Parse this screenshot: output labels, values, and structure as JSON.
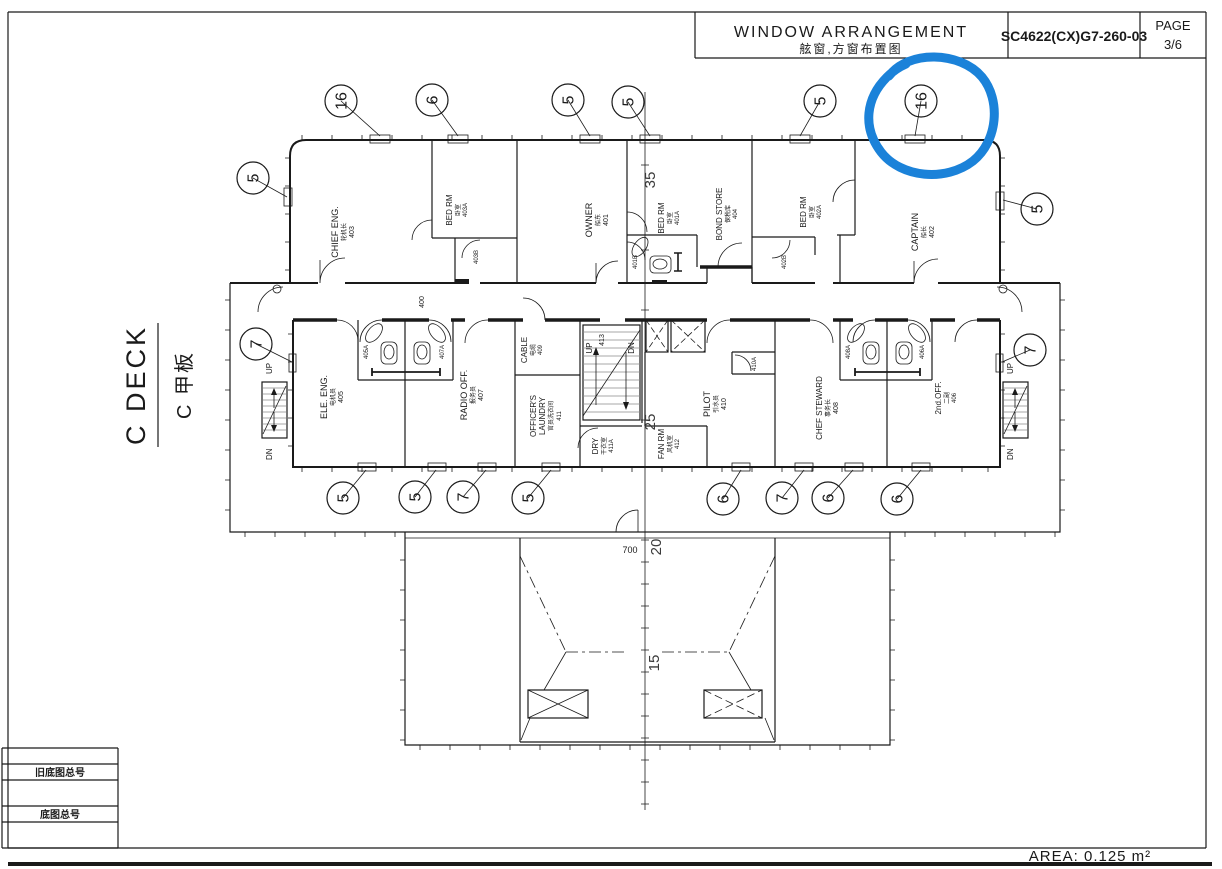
{
  "title_block": {
    "title_en": "WINDOW  ARRANGEMENT",
    "title_zh": "舷窗,方窗布置图",
    "drawing_no": "SC4622(CX)G7-260-03",
    "page_label": "PAGE",
    "page_no": "3/6"
  },
  "deck_label": {
    "en": "C DECK",
    "zh": "C 甲板"
  },
  "footer": {
    "area": "AREA: 0.125 m²"
  },
  "stamp_table": {
    "row1": "旧底图总号",
    "row2": "底图总号"
  },
  "corridor": {
    "no": "400"
  },
  "rooms": {
    "chief_eng": {
      "en": "CHIEF ENG.",
      "zh": "轮机长",
      "no": "403"
    },
    "bed_rm_403a": {
      "en": "BED RM",
      "zh": "卧室",
      "no": "403A"
    },
    "wc_403b": {
      "no": "403B"
    },
    "owner": {
      "en": "OWNER",
      "zh": "船东",
      "no": "401"
    },
    "bed_rm_401a": {
      "en": "BED RM",
      "zh": "卧室",
      "no": "401A"
    },
    "wc_401b": {
      "no": "401B"
    },
    "bond_store": {
      "en": "BOND STORE",
      "zh": "保税库",
      "no": "404"
    },
    "bed_rm_402a": {
      "en": "BED RM",
      "zh": "卧室",
      "no": "402A"
    },
    "wc_402b": {
      "no": "402B"
    },
    "captain": {
      "en": "CAPTAIN",
      "zh": "船长",
      "no": "402"
    },
    "ele_eng": {
      "en": "ELE. ENG.",
      "zh": "电机员",
      "no": "405"
    },
    "wc_405a": {
      "no": "405A"
    },
    "wc_407a": {
      "no": "407A"
    },
    "radio_off": {
      "en": "RADIO OFF.",
      "zh": "报务员",
      "no": "407"
    },
    "cable": {
      "en": "CABLE",
      "zh": "电缆",
      "no": "409"
    },
    "officers_laundry": {
      "en1": "OFFICER'S",
      "en2": "LAUNDRY",
      "zh": "官员洗衣间",
      "no": "411"
    },
    "stair": {
      "up": "UP",
      "no": "413",
      "dn": "DN"
    },
    "dry": {
      "en": "DRY",
      "zh": "干衣室",
      "no": "411A"
    },
    "fan_rm": {
      "en": "FAN RM",
      "zh": "风机室",
      "no": "412"
    },
    "pilot": {
      "en": "PILOT",
      "zh": "引水员",
      "no": "410"
    },
    "wc_410a": {
      "no": "410A"
    },
    "chief_steward": {
      "en": "CHEF STEWARD",
      "zh": "事务长",
      "no": "408"
    },
    "wc_408a": {
      "no": "408A"
    },
    "wc_406a": {
      "no": "406A"
    },
    "second_off": {
      "en": "2nd.OFF.",
      "zh": "二副",
      "no": "406"
    }
  },
  "wing_stairs": {
    "up": "UP",
    "dn": "DN"
  },
  "dimensions": {
    "d35": "35",
    "d25": "25",
    "d20": "20",
    "d15": "15",
    "d700": "700"
  },
  "balloons": {
    "top": [
      "16",
      "6",
      "5",
      "5",
      "5",
      "16"
    ],
    "left": [
      "5",
      "7"
    ],
    "right": [
      "5",
      "7"
    ],
    "bottom": [
      "5",
      "5",
      "7",
      "5",
      "6",
      "7",
      "6",
      "6"
    ]
  },
  "annotation": {
    "highlight_color": "#1b82d9",
    "highlighted_balloon": "16"
  }
}
